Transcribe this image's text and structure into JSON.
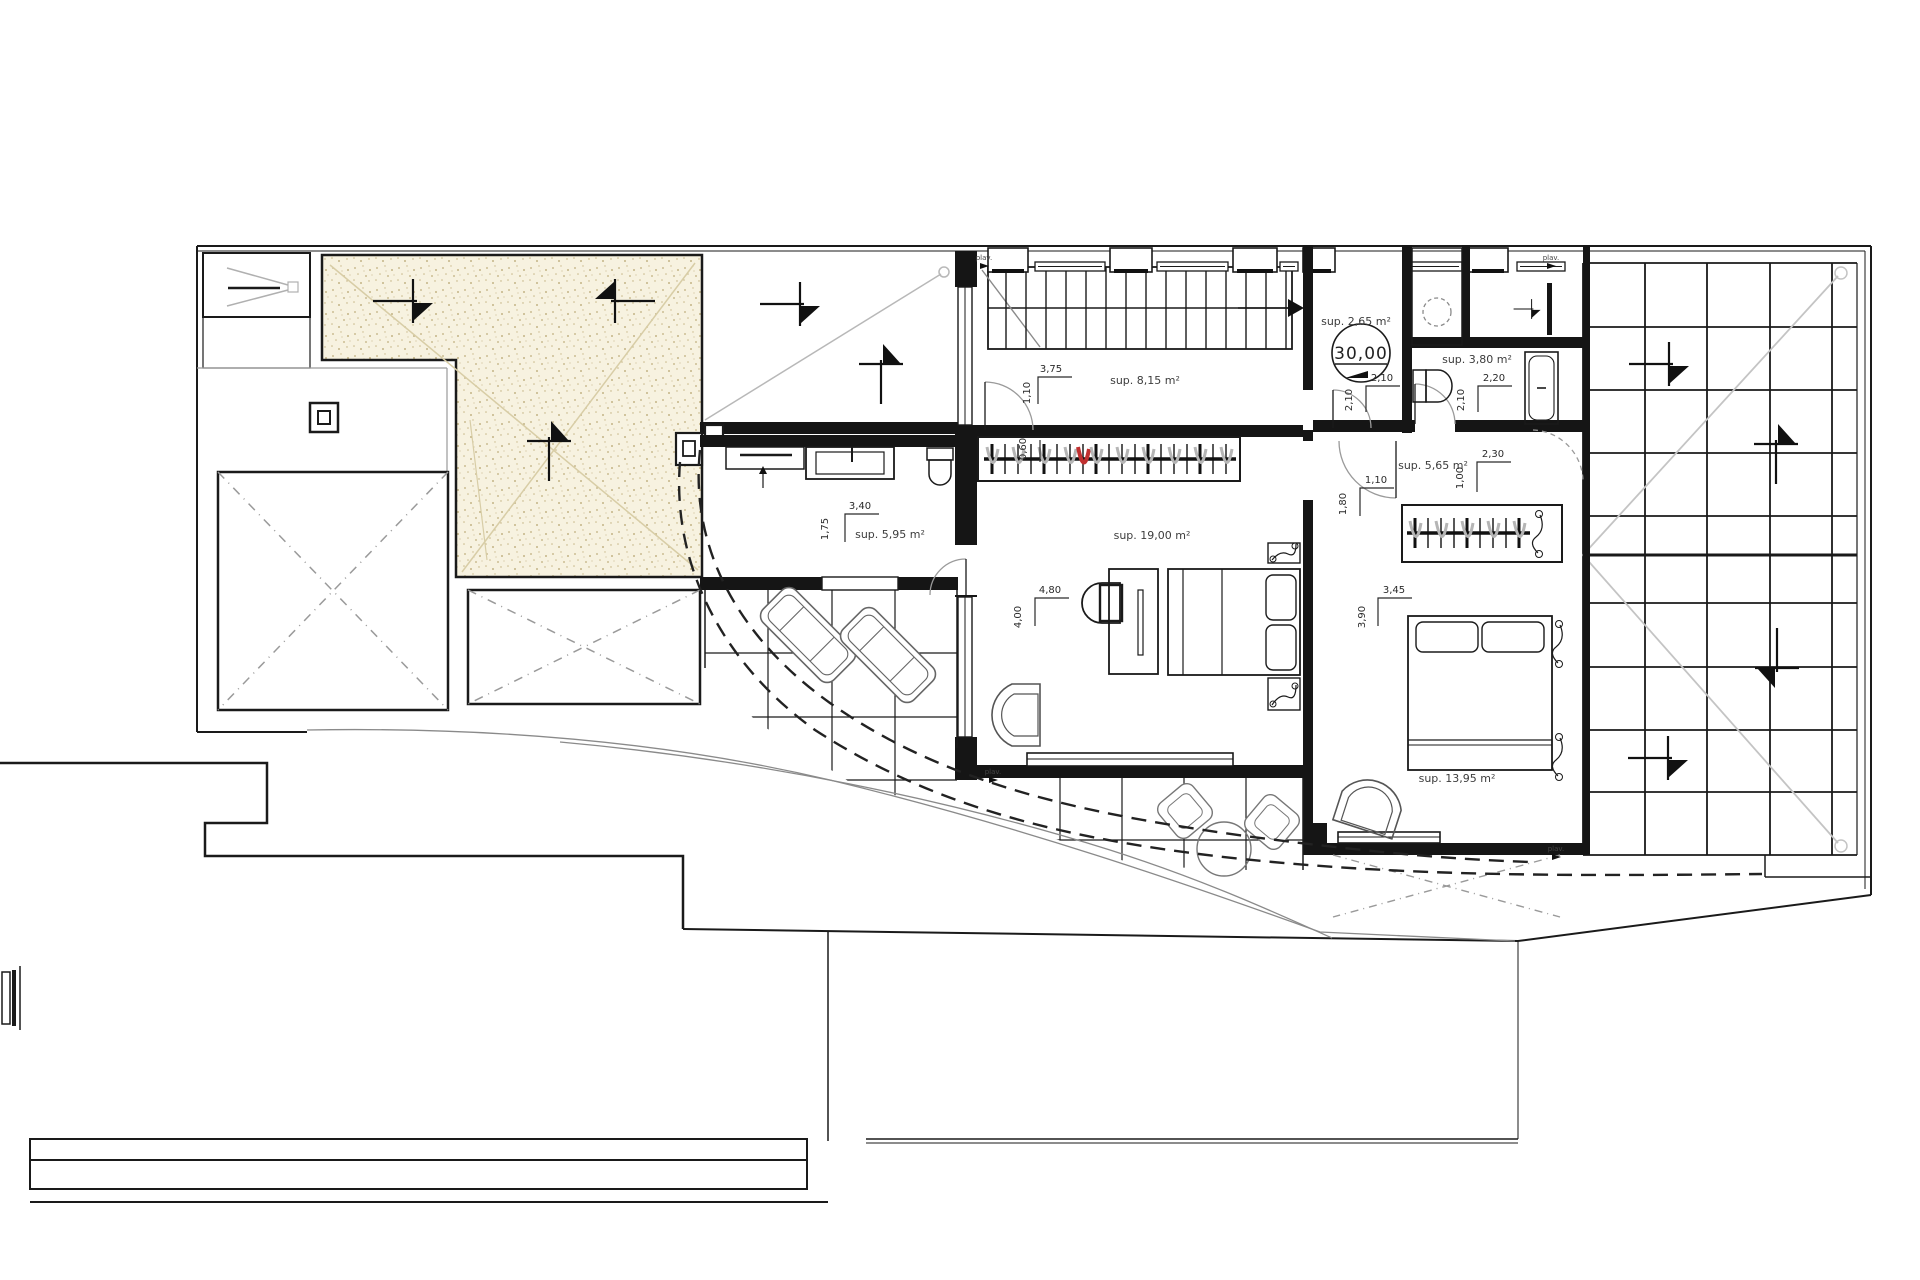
{
  "title": "floor-plan",
  "colors": {
    "paper": "#ffffff",
    "line": "#1a1a1a",
    "gray": "#9a9a9a",
    "light_gray": "#c4c4c4",
    "stipple_bg": "#f7f2e0",
    "stipple_dot": "#bfae7c",
    "stipple_line": "#d8cda6",
    "red_accent": "#c03030"
  },
  "level_marker": {
    "value": "30,00",
    "area": "sup. 2,65 m²"
  },
  "area_labels": [
    {
      "name": "corridor-area",
      "text": "sup. 8,15 m²",
      "x": 1145,
      "y": 384
    },
    {
      "name": "bathroom2-area",
      "text": "sup. 3,80 m²",
      "x": 1477,
      "y": 363
    },
    {
      "name": "dressing-area",
      "text": "sup. 5,65 m²",
      "x": 1433,
      "y": 469
    },
    {
      "name": "bathroom1-area",
      "text": "sup. 5,95 m²",
      "x": 890,
      "y": 538
    },
    {
      "name": "bedroom1-area",
      "text": "sup. 19,00 m²",
      "x": 1152,
      "y": 539
    },
    {
      "name": "bedroom2-area",
      "text": "sup. 13,95 m²",
      "x": 1457,
      "y": 782
    }
  ],
  "dimension_labels": [
    {
      "text": "3,75",
      "x": 1051,
      "y": 372,
      "r": 0
    },
    {
      "text": "1,10",
      "x": 1030,
      "y": 393,
      "r": -90
    },
    {
      "text": "2,10",
      "x": 1382,
      "y": 381,
      "r": 0
    },
    {
      "text": "2,10",
      "x": 1352,
      "y": 400,
      "r": -90
    },
    {
      "text": "2,20",
      "x": 1494,
      "y": 381,
      "r": 0
    },
    {
      "text": "2,10",
      "x": 1464,
      "y": 400,
      "r": -90
    },
    {
      "text": "2,30",
      "x": 1493,
      "y": 457,
      "r": 0
    },
    {
      "text": "1,00",
      "x": 1463,
      "y": 478,
      "r": -90
    },
    {
      "text": "1,10",
      "x": 1376,
      "y": 483,
      "r": 0
    },
    {
      "text": "1,80",
      "x": 1346,
      "y": 504,
      "r": -90
    },
    {
      "text": "3,40",
      "x": 860,
      "y": 509,
      "r": 0
    },
    {
      "text": "1,75",
      "x": 828,
      "y": 529,
      "r": -90
    },
    {
      "text": "4,80",
      "x": 1050,
      "y": 593,
      "r": 0
    },
    {
      "text": "4,00",
      "x": 1021,
      "y": 617,
      "r": -90
    },
    {
      "text": "3,45",
      "x": 1394,
      "y": 593,
      "r": 0
    },
    {
      "text": "3,90",
      "x": 1365,
      "y": 617,
      "r": -90
    },
    {
      "text": "0,60",
      "x": 1026,
      "y": 449,
      "r": -90
    }
  ],
  "small_labels": [
    {
      "text": "plav.",
      "x": 984,
      "y": 260
    },
    {
      "text": "plav.",
      "x": 1551,
      "y": 260
    },
    {
      "text": "plav.",
      "x": 993,
      "y": 774
    },
    {
      "text": "plav.",
      "x": 1556,
      "y": 851
    }
  ],
  "symbols": [
    {
      "name": "slope-arrow",
      "x": 405,
      "y": 301,
      "r": 0
    },
    {
      "name": "slope-arrow",
      "x": 623,
      "y": 301,
      "r": 180
    },
    {
      "name": "slope-arrow",
      "x": 549,
      "y": 449,
      "r": -90
    },
    {
      "name": "slope-arrow",
      "x": 792,
      "y": 304,
      "r": 0
    },
    {
      "name": "slope-arrow",
      "x": 881,
      "y": 372,
      "r": -90
    },
    {
      "name": "slope-arrow",
      "x": 1661,
      "y": 364,
      "r": 0
    },
    {
      "name": "slope-arrow",
      "x": 1776,
      "y": 452,
      "r": -90
    },
    {
      "name": "slope-arrow",
      "x": 1777,
      "y": 660,
      "r": 90
    },
    {
      "name": "slope-arrow",
      "x": 1660,
      "y": 758,
      "r": 0
    },
    {
      "name": "slope-arrow",
      "x": 1528,
      "y": 309,
      "r": 0,
      "s": 0.45
    }
  ]
}
